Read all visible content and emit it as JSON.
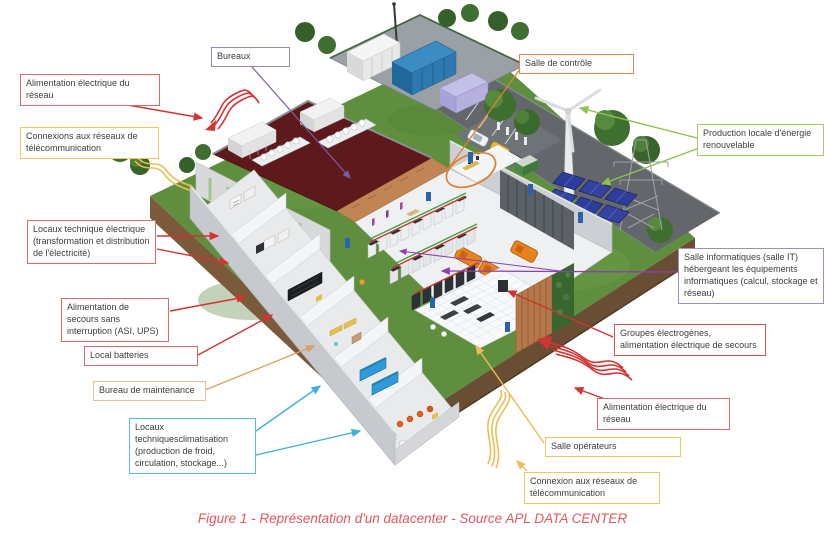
{
  "figure": {
    "caption": "Figure 1 - Représentation d'un datacenter - Source APL DATA CENTER",
    "caption_color": "#e4565e"
  },
  "callouts": [
    {
      "id": "alimentation-electrique-reseau-haut",
      "text": "Alimentation électrique du réseau",
      "border_color": "#d96b6b"
    },
    {
      "id": "connexions-reseaux-telecom-haut",
      "text": "Connexions aux réseaux de télécommunication",
      "border_color": "#eec95f"
    },
    {
      "id": "bureaux",
      "text": "Bureaux",
      "border_color": "#9c87ba"
    },
    {
      "id": "salle-de-controle",
      "text": "Salle de contrôle",
      "border_color": "#e08a4a"
    },
    {
      "id": "production-locale-energie",
      "text": "Production locale d'énergie renouvelable",
      "border_color": "#a7c968"
    },
    {
      "id": "locaux-technique-electrique",
      "text": "Locaux technique électrique (transformation et distribution de l'électricité)",
      "border_color": "#d96b6b"
    },
    {
      "id": "alimentation-secours-asi-ups",
      "text": "Alimentation de secours sans interruption (ASI, UPS)",
      "border_color": "#d96b6b"
    },
    {
      "id": "local-batteries",
      "text": "Local batteries",
      "border_color": "#d96b6b"
    },
    {
      "id": "bureau-de-maintenance",
      "text": "Bureau de maintenance",
      "border_color": "#e5c190"
    },
    {
      "id": "locaux-techniques-climatisation",
      "text": "Locaux techniquesclimatisation (production de froid, circulation, stockage...)",
      "border_color": "#59bcd9"
    },
    {
      "id": "salle-informatique-it",
      "text": "Salle informatiques (salle IT) hébergeant les équipements informatiques (calcul, stockage et réseau)",
      "border_color": "#a18cc2"
    },
    {
      "id": "groupes-electrogenes",
      "text": "Groupes électrogènes, alimentation électrique de secours",
      "border_color": "#cd5a4b"
    },
    {
      "id": "alimentation-electrique-reseau-bas",
      "text": "Alimentation électrique du réseau",
      "border_color": "#d96b6b"
    },
    {
      "id": "salle-operateurs",
      "text": "Salle opérateurs",
      "border_color": "#eec95f"
    },
    {
      "id": "connexion-reseaux-telecom-bas",
      "text": "Connexion aux réseaux de télécommunication",
      "border_color": "#eec95f"
    }
  ],
  "scene_colors": {
    "grass": "#5f8f3e",
    "soil_edge": "#6a4e33",
    "road": "#63676c",
    "office_roof": "#5e191c",
    "wood_wall": "#c08455",
    "generator_orange": "#e8821e",
    "chiller_blue": "#2f9ad8",
    "solar_panel": "#2e3d9b",
    "power_arrow_red": "#d23333",
    "telecom_arrow_yellow": "#e9bf55",
    "it_arrow_violet": "#8e3fae",
    "renewable_green": "#8fc24c"
  }
}
